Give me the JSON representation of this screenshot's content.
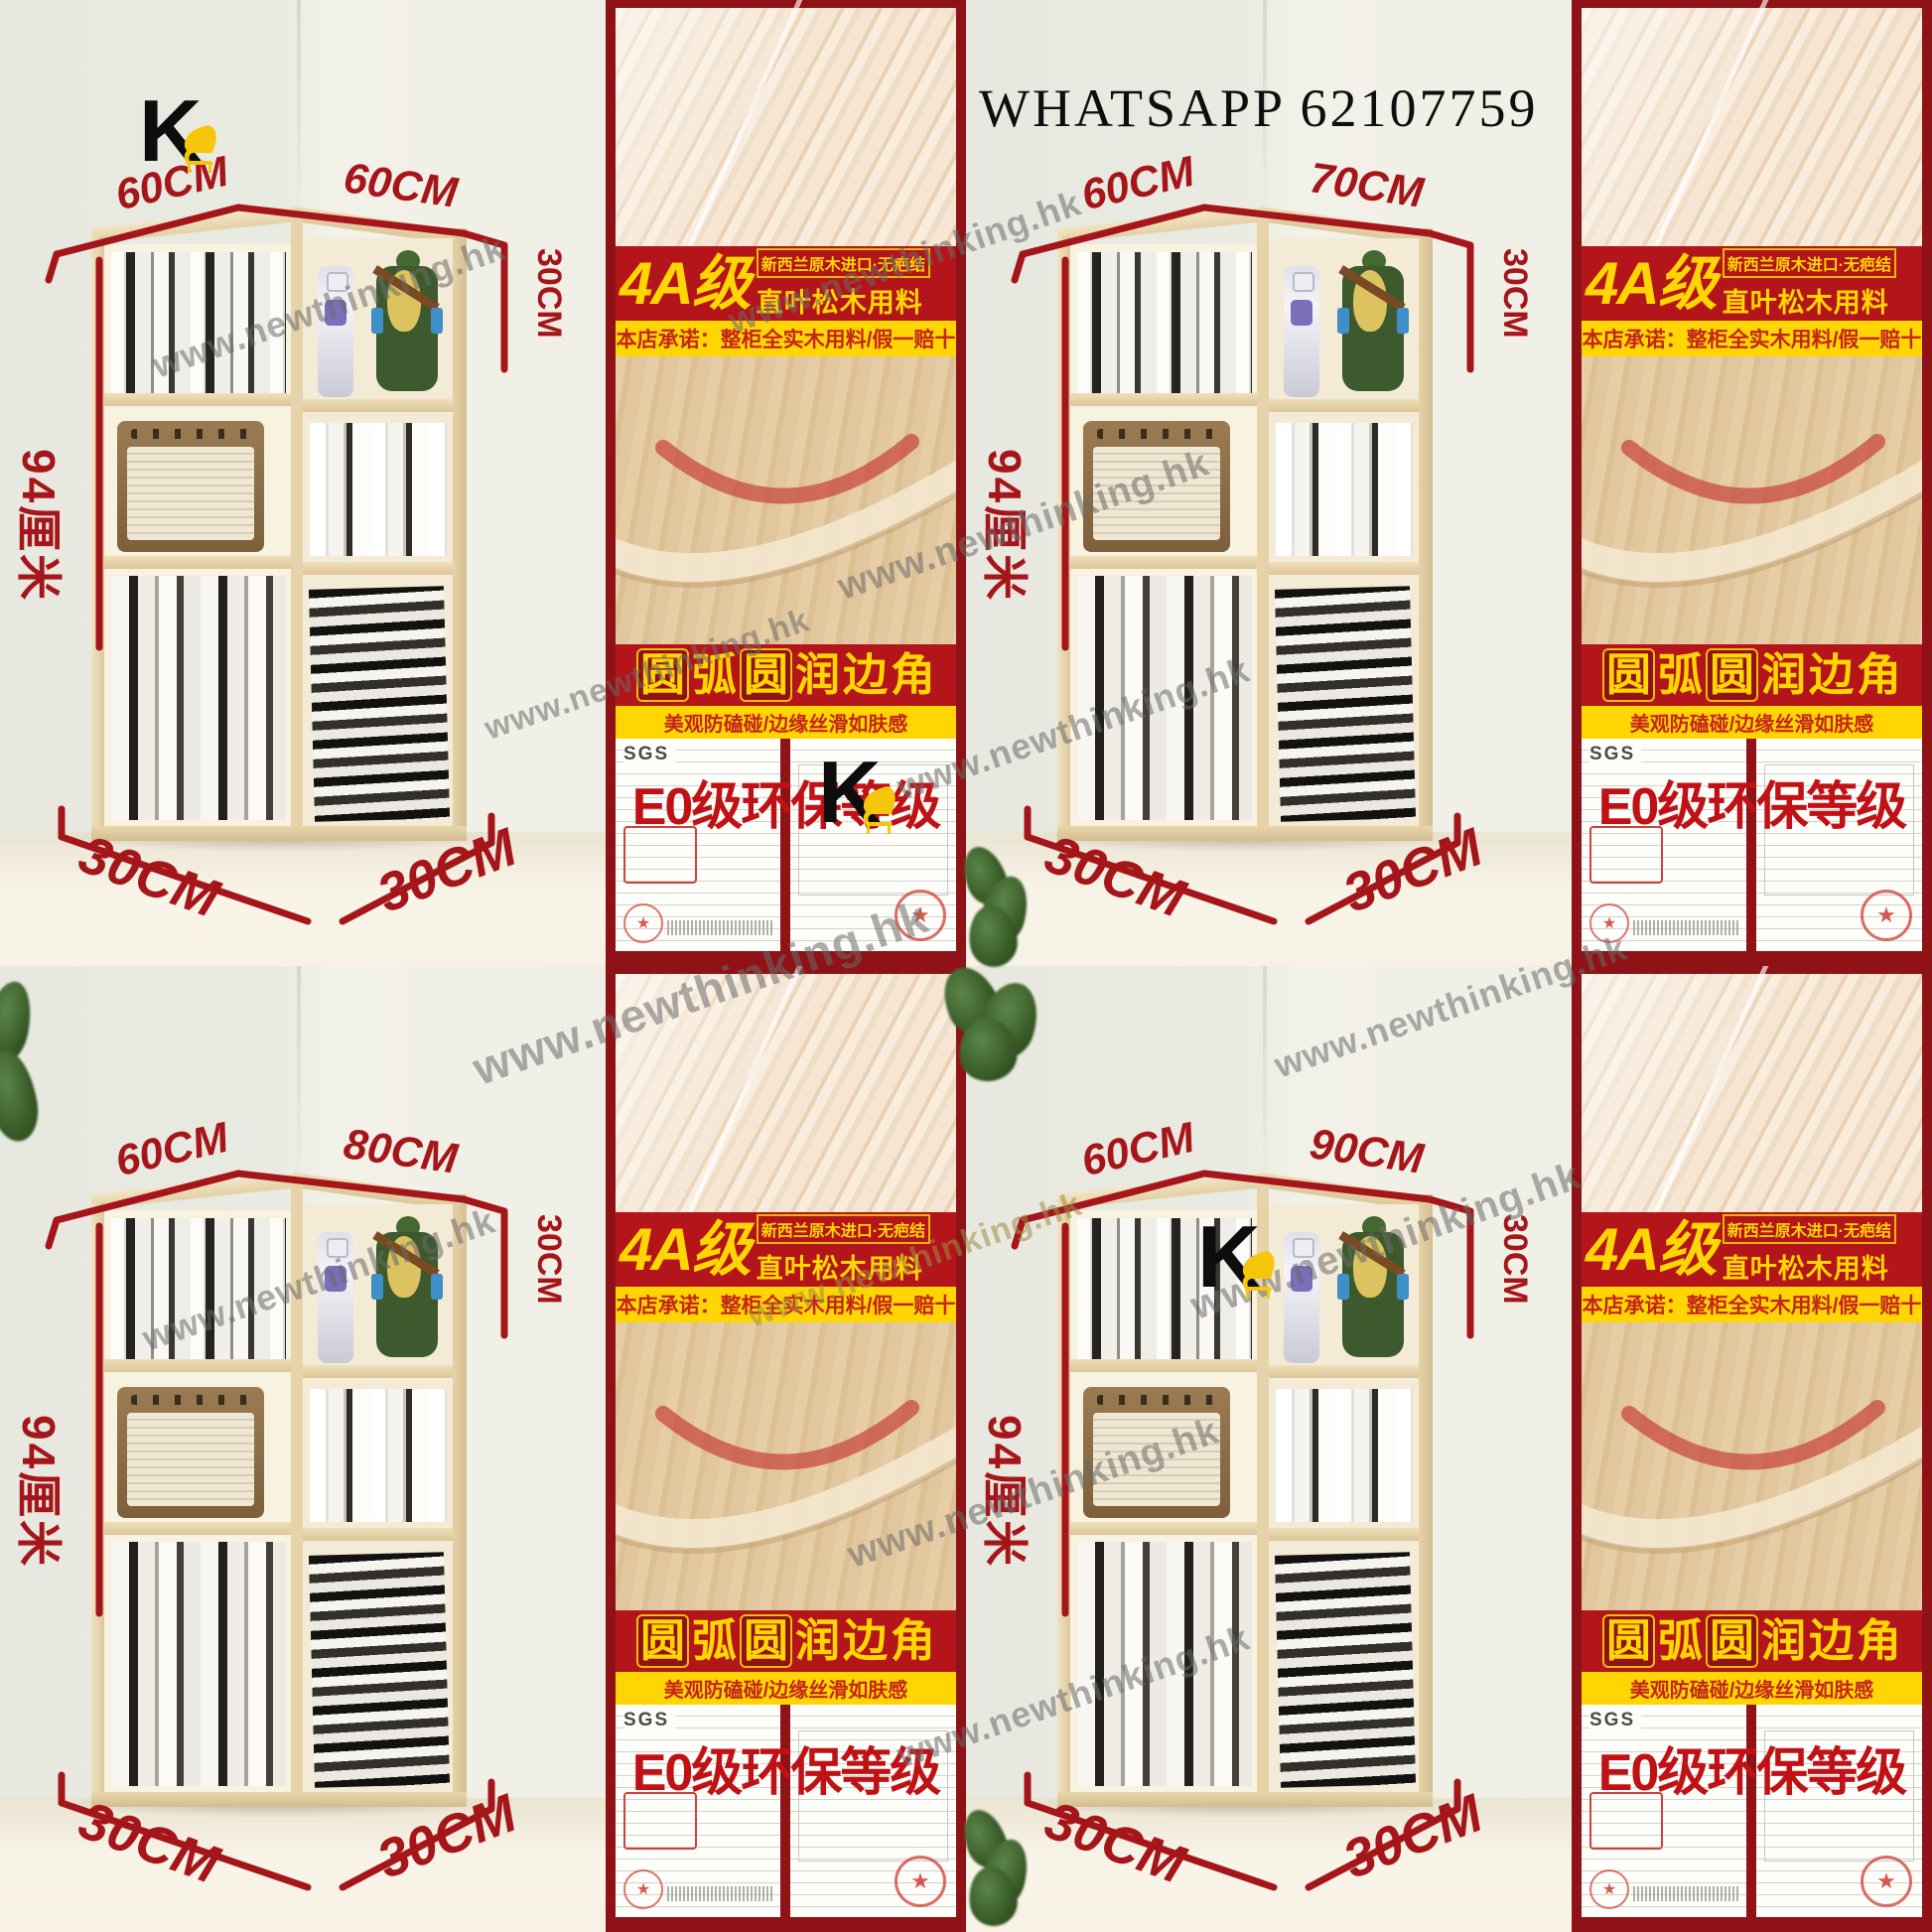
{
  "header": {
    "whatsapp_text": "WHATSAPP 62107759"
  },
  "brand": {
    "letter": "K"
  },
  "watermark": {
    "text": "www.newthinking.hk"
  },
  "panel": {
    "grade_title": "4A级",
    "grade_sub_top": "新西兰原木进口·无疤结",
    "grade_sub_bottom": "直叶松木用料",
    "promise_text": "本店承诺：整柜全实木用料/假一赔十",
    "edge_chars": [
      "圆",
      "弧",
      "圆",
      "润",
      "边",
      "角"
    ],
    "edge_subtitle": "美观防磕碰/边缘丝滑如肤感",
    "env_title": "E0级环保等级",
    "cert_logo": "SGS",
    "stamp_star": "★"
  },
  "tiles": [
    {
      "top_left": "60CM",
      "top_right": "60CM",
      "height_label": "94厘米",
      "depth_label": "30CM",
      "bottom_left": "30CM",
      "bottom_right": "30CM"
    },
    {
      "top_left": "60CM",
      "top_right": "70CM",
      "height_label": "94厘米",
      "depth_label": "30CM",
      "bottom_left": "30CM",
      "bottom_right": "30CM"
    },
    {
      "top_left": "60CM",
      "top_right": "80CM",
      "height_label": "94厘米",
      "depth_label": "30CM",
      "bottom_left": "30CM",
      "bottom_right": "30CM"
    },
    {
      "top_left": "60CM",
      "top_right": "90CM",
      "height_label": "94厘米",
      "depth_label": "30CM",
      "bottom_left": "30CM",
      "bottom_right": "30CM"
    }
  ]
}
